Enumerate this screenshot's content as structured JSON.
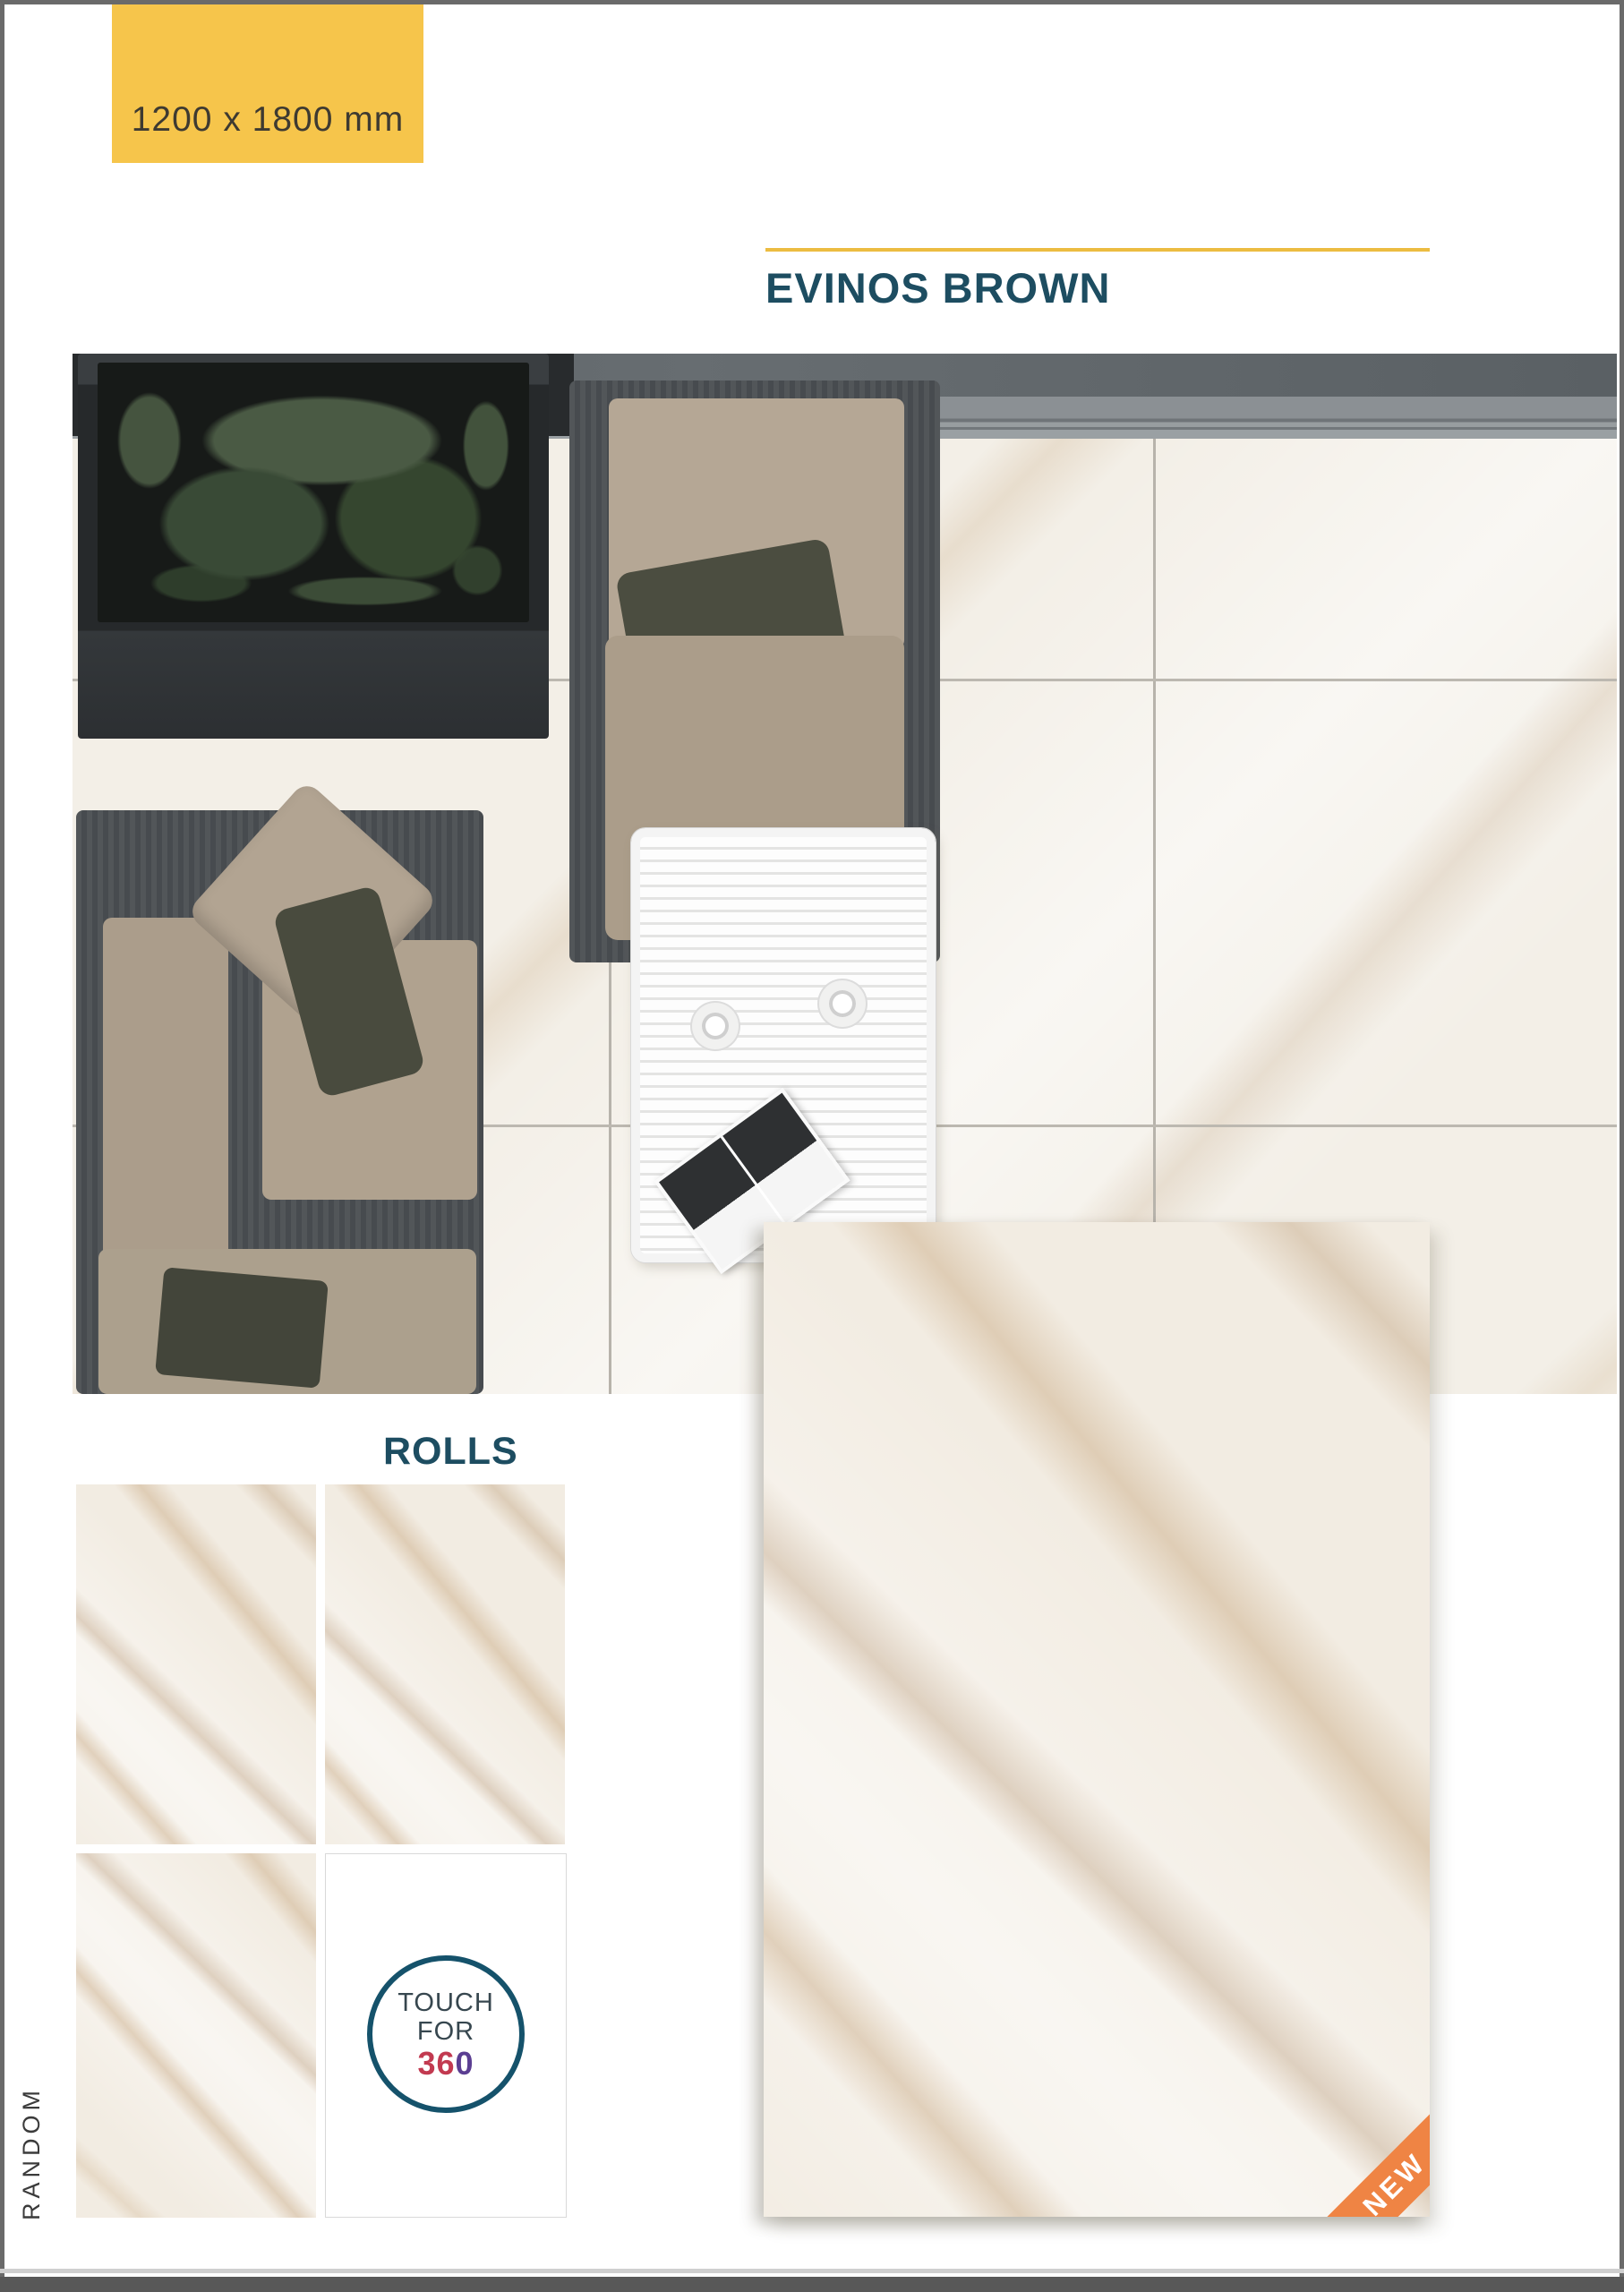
{
  "badge": {
    "label": "1200 x 1800 mm"
  },
  "header": {
    "title": "EVINOS BROWN"
  },
  "rolls": {
    "label": "ROLLS"
  },
  "touch_badge": {
    "line1": "TOUCH",
    "line2": "FOR",
    "num_red": "36",
    "num_purple": "0"
  },
  "ribbon": {
    "label": "NEW"
  },
  "side_label": {
    "label": "RANDOM"
  },
  "colors": {
    "badge_bg": "#f6c54b",
    "accent_rule": "#ecbc41",
    "title_text": "#1d4d61",
    "ribbon_bg": "#ef8444",
    "touch_circle_stroke": "#15526b",
    "touch_num_red": "#c23a50",
    "touch_num_purple": "#5b3e92",
    "frame_border": "#6a6a6a",
    "marble_base": "#f2ece2"
  },
  "icons": {
    "touch_circle": "360-rotation-badge",
    "ribbon": "corner-new-ribbon"
  }
}
